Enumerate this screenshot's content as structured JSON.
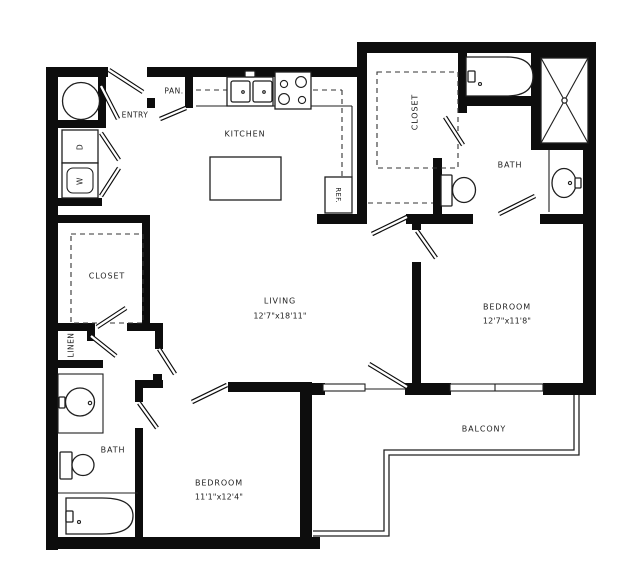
{
  "floorplan": {
    "background": "#ffffff",
    "wall_color": "#0d0d0d",
    "line_color": "#1f1f1f",
    "rooms": {
      "entry": {
        "label": "ENTRY"
      },
      "pantry": {
        "label": "PAN."
      },
      "kitchen": {
        "label": "KITCHEN"
      },
      "living": {
        "label": "LIVING",
        "dimensions": "12'7\"x18'11\""
      },
      "master_closet": {
        "label": "CLOSET"
      },
      "master_bath": {
        "label": "BATH"
      },
      "master_bedroom": {
        "label": "BEDROOM",
        "dimensions": "12'7\"x11'8\""
      },
      "second_closet": {
        "label": "CLOSET"
      },
      "linen": {
        "label": "LINEN"
      },
      "second_bath": {
        "label": "BATH"
      },
      "second_bedroom": {
        "label": "BEDROOM",
        "dimensions": "11'1\"x12'4\""
      },
      "balcony": {
        "label": "BALCONY"
      }
    },
    "appliances": {
      "dryer": {
        "label": "D"
      },
      "washer": {
        "label": "W"
      },
      "refrigerator": {
        "label": "REF."
      }
    }
  }
}
